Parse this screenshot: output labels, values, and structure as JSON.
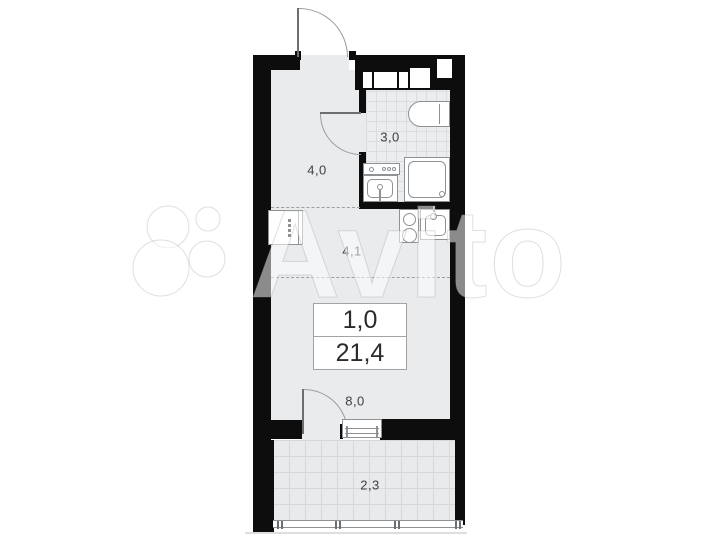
{
  "plan": {
    "type": "apartment-floor-plan",
    "unit_box": {
      "rooms_value": "1,0",
      "area_value": "21,4"
    },
    "rooms": [
      {
        "id": "hallway",
        "label": "4,0"
      },
      {
        "id": "bathroom",
        "label": "3,0"
      },
      {
        "id": "kitchen",
        "label": "4,1"
      },
      {
        "id": "living",
        "label": "8,0"
      },
      {
        "id": "balcony",
        "label": "2,3"
      }
    ],
    "fixtures": [
      "entrance-door",
      "bathroom-door",
      "balcony-door",
      "toilet",
      "shower-cabin",
      "washbasin",
      "wardrobe",
      "hob",
      "kitchen-sink",
      "window",
      "balcony-glazing",
      "ventilation-shafts"
    ],
    "watermark": {
      "brand": "Avito"
    },
    "colors": {
      "wall": "#0d0d0d",
      "floor": "#e9ebec",
      "tile_line": "#dadcde",
      "fixture_line": "#8e9294",
      "label_text": "#3f3f3f",
      "background": "#ffffff"
    }
  }
}
